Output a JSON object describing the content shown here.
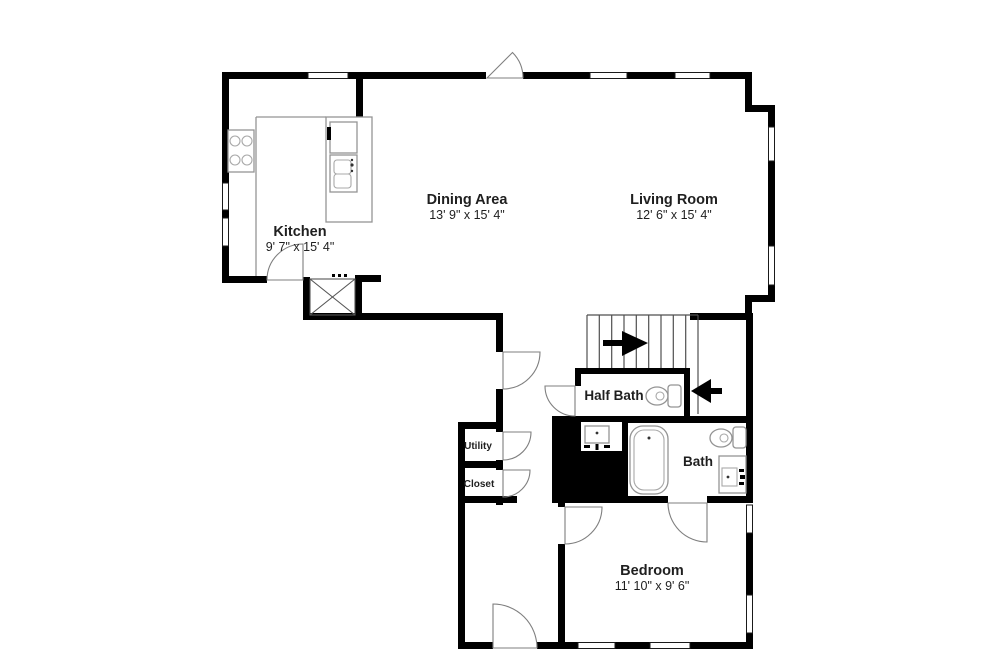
{
  "plan": {
    "rooms": {
      "kitchen": {
        "label": "Kitchen",
        "dims": "9' 7\" x 15' 4\""
      },
      "dining_area": {
        "label": "Dining Area",
        "dims": "13' 9\" x 15' 4\""
      },
      "living_room": {
        "label": "Living Room",
        "dims": "12' 6\" x 15' 4\""
      },
      "half_bath": {
        "label": "Half Bath"
      },
      "bath": {
        "label": "Bath"
      },
      "bedroom": {
        "label": "Bedroom",
        "dims": "11' 10\" x 9' 6\""
      },
      "utility": {
        "label": "Utility"
      },
      "closet": {
        "label": "Closet"
      }
    },
    "colors": {
      "wall": "#000000",
      "fixture_line": "#949494",
      "text": "#1f1f1f",
      "background": "#ffffff"
    }
  }
}
